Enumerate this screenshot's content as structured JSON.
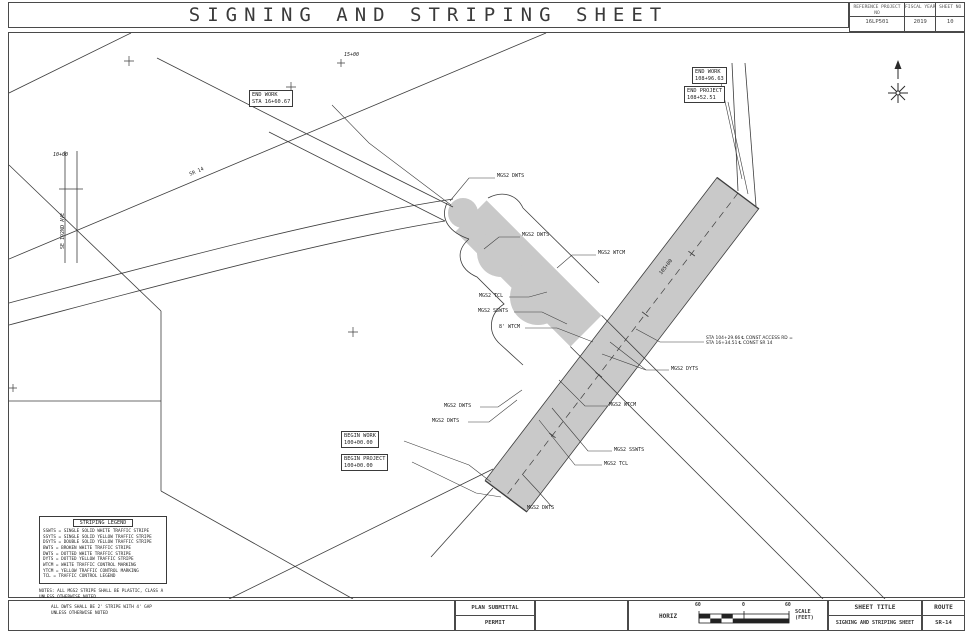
{
  "header": {
    "title": "SIGNING AND STRIPING SHEET",
    "reference_label": "REFERENCE PROJECT NO",
    "reference_value": "16LP501",
    "fiscal_label": "FISCAL YEAR",
    "fiscal_value": "2019",
    "sheet_label": "SHEET NO",
    "sheet_value": "10"
  },
  "plan": {
    "callouts": {
      "end_work_sta": {
        "line1": "END WORK",
        "line2": "STA 16+60.67"
      },
      "end_work": {
        "line1": "END WORK",
        "line2": "108+96.63"
      },
      "end_project": {
        "line1": "END PROJECT",
        "line2": "108+52.51"
      },
      "begin_work": {
        "line1": "BEGIN WORK",
        "line2": "100+00.00"
      },
      "begin_project": {
        "line1": "BEGIN PROJECT",
        "line2": "100+00.00"
      }
    },
    "tags": {
      "dwts": "MGS2 DWTS",
      "dyts": "MGS2 DYTS",
      "wtcm": "MGS2 WTCM",
      "sswts": "MGS2 SSWTS",
      "tcl": "MGS2 TCL",
      "wtcm8": "8' WTCM"
    },
    "equation": {
      "line1": "STA 104+29.66 ℄ CONST ACCESS RD =",
      "line2": "STA 16+34.51 ℄ CONST SR 14"
    },
    "stations": {
      "s15": "15+00",
      "s10": "10+00",
      "s105": "105+00"
    },
    "roads": {
      "sr14": "SR 14",
      "se192": "SE 192ND AVE"
    }
  },
  "legend": {
    "title": "STRIPING LEGEND",
    "items": [
      "SSWTS = SINGLE SOLID WHITE TRAFFIC STRIPE",
      "SSYTS = SINGLE SOLID YELLOW TRAFFIC STRIPE",
      "DSYTS = DOUBLE SOLID YELLOW TRAFFIC STRIPE",
      "BWTS  = BROKEN WHITE TRAFFIC STRIPE",
      "DWTS  = DOTTED WHITE TRAFFIC STRIPE",
      "DYTS  = DOTTED YELLOW TRAFFIC STRIPE",
      "WTCM  = WHITE TRAFFIC CONTROL MARKING",
      "YTCM  = YELLOW TRAFFIC CONTROL MARKING",
      "TCL   = TRAFFIC CONTROL LEGEND"
    ],
    "note1": "NOTES: ALL MGS2 STRIPE SHALL BE PLASTIC, CLASS A UNLESS OTHERWISE NOTED",
    "note2": "ALL DWTS SHALL BE 2' STRIPE WITH 4' GAP UNLESS OTHERWISE NOTED"
  },
  "bottom": {
    "plan_submittal": "PLAN SUBMITTAL",
    "permit": "PERMIT",
    "horiz": "HORIZ",
    "scale_left": "60",
    "scale_zero": "0",
    "scale_right": "60",
    "scale_caption_1": "SCALE",
    "scale_caption_2": "(FEET)",
    "sheet_title_label": "SHEET TITLE",
    "route_label": "ROUTE",
    "sheet_title_value": "SIGNING AND STRIPING SHEET",
    "route_value": "SR-14"
  }
}
